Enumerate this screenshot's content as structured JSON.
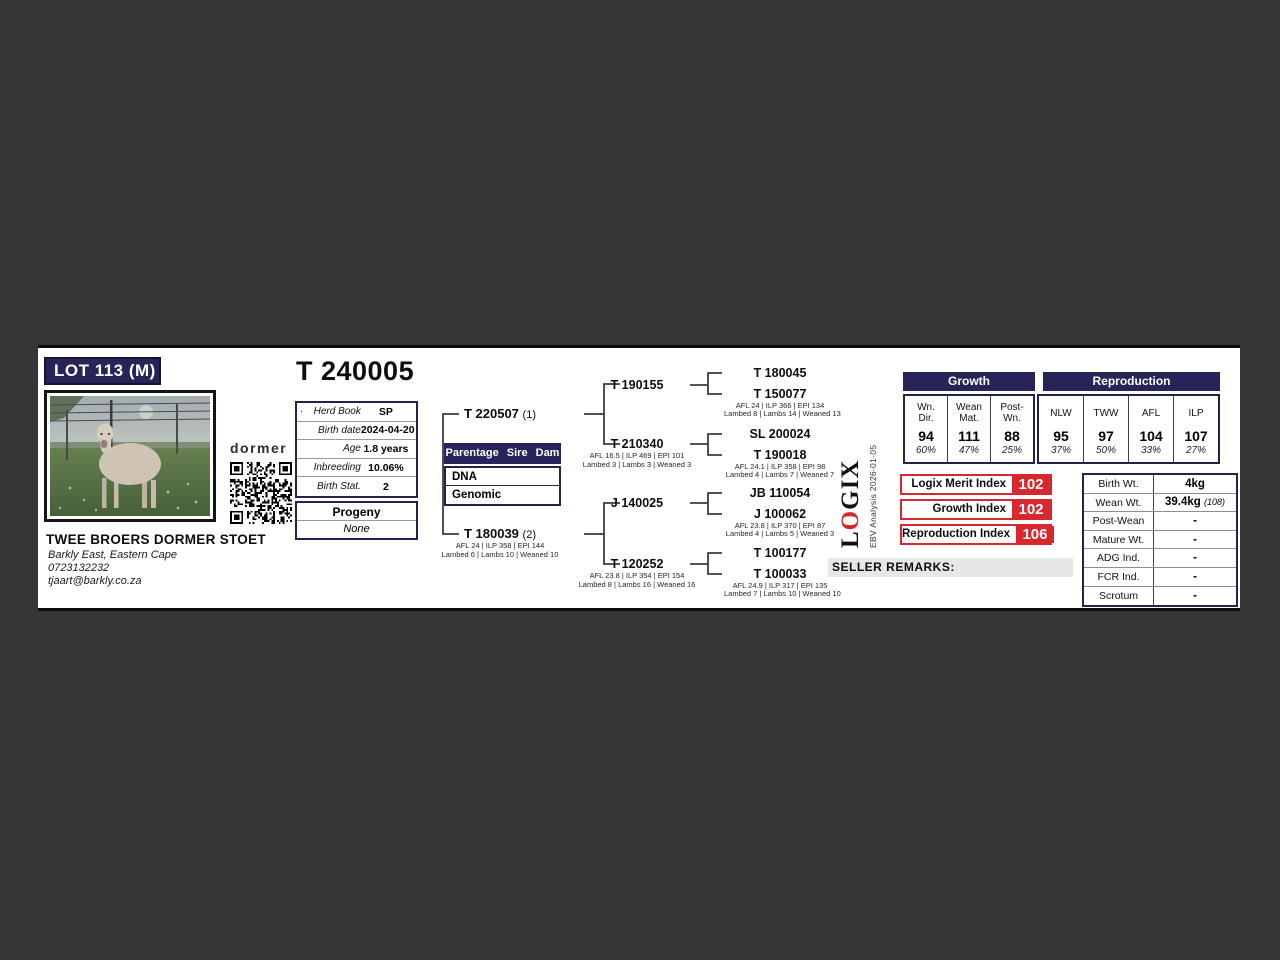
{
  "card": {
    "lot_badge": "LOT 113 (M)",
    "animal_id": "T 240005"
  },
  "breeder": {
    "brand": "dormer",
    "name": "TWEE BROERS DORMER STOET",
    "location": "Barkly East, Eastern Cape",
    "phone": "0723132232",
    "email": "tjaart@barkly.co.za"
  },
  "info": {
    "rows": [
      {
        "prefix": ".",
        "label": "Herd Book",
        "value": "SP"
      },
      {
        "label": "Birth date",
        "value": "2024-04-20"
      },
      {
        "label": "Age",
        "value": "1.8 years"
      },
      {
        "label": "Inbreeding",
        "value": "10.06%"
      },
      {
        "label": "Birth Stat.",
        "value": "2"
      }
    ]
  },
  "progeny": {
    "header": "Progeny",
    "value": "None"
  },
  "parentage": {
    "header": "Parentage Sire Dam",
    "rows": [
      "DNA",
      "Genomic"
    ]
  },
  "pedigree": {
    "sire": {
      "id": "T 220507",
      "tag": "(1)"
    },
    "dam": {
      "id": "T 180039",
      "tag": "(2)",
      "stats": "AFL 24 | ILP 358 | EPI 144",
      "lambing": "Lambed 6 | Lambs 10 | Weaned 10"
    },
    "gen2": [
      {
        "id": "T 190155"
      },
      {
        "id": "T 210340",
        "stats": "AFL 16.5 | ILP 469 | EPI 101",
        "lambing": "Lambed 3 | Lambs 3 | Weaned 3"
      },
      {
        "id": "J 140025"
      },
      {
        "id": "T 120252",
        "stats": "AFL 23.8 | ILP 354 | EPI 154",
        "lambing": "Lambed 8 | Lambs 16 | Weaned 16"
      }
    ],
    "gen3": [
      {
        "id": "T 180045"
      },
      {
        "id": "T 150077",
        "stats": "AFL 24 | ILP 366 | EPI 134",
        "lambing": "Lambed 8 | Lambs 14 | Weaned 13"
      },
      {
        "id": "SL 200024"
      },
      {
        "id": "T 190018",
        "stats": "AFL 24.1 | ILP 358 | EPI 98",
        "lambing": "Lambed 4 | Lambs 7 | Weaned 7"
      },
      {
        "id": "JB 110054"
      },
      {
        "id": "J 100062",
        "stats": "AFL 23.8 | ILP 370 | EPI 87",
        "lambing": "Lambed 4 | Lambs 5 | Weaned 3"
      },
      {
        "id": "T 100177"
      },
      {
        "id": "T 100033",
        "stats": "AFL 24.9 | ILP 317 | EPI 135",
        "lambing": "Lambed 7 | Lambs 10 | Weaned 10"
      }
    ]
  },
  "ebv": {
    "growth": {
      "header": "Growth",
      "cols": [
        {
          "l1": "Wn.",
          "l2": "Dir.",
          "value": "94",
          "acc": "60%"
        },
        {
          "l1": "Wean",
          "l2": "Mat.",
          "value": "111",
          "acc": "47%"
        },
        {
          "l1": "Post-",
          "l2": "Wn.",
          "value": "88",
          "acc": "25%"
        }
      ]
    },
    "reproduction": {
      "header": "Reproduction",
      "cols": [
        {
          "l1": "NLW",
          "value": "95",
          "acc": "37%"
        },
        {
          "l1": "TWW",
          "value": "97",
          "acc": "50%"
        },
        {
          "l1": "AFL",
          "value": "104",
          "acc": "33%"
        },
        {
          "l1": "ILP",
          "value": "107",
          "acc": "27%"
        }
      ]
    }
  },
  "logix": {
    "logo_l": "L",
    "logo_o": "O",
    "logo_gix": "GIX",
    "analysis": "EBV Analysis 2026-01-05",
    "indices": [
      {
        "label": "Logix Merit Index",
        "value": "102"
      },
      {
        "label": "Growth Index",
        "value": "102"
      },
      {
        "label": "Reproduction Index",
        "value": "106"
      }
    ]
  },
  "seller_remarks_label": "SELLER REMARKS:",
  "weights": {
    "rows": [
      {
        "label": "Birth Wt.",
        "value": "4kg",
        "note": ""
      },
      {
        "label": "Wean Wt.",
        "value": "39.4kg",
        "note": "(108)"
      },
      {
        "label": "Post-Wean",
        "value": "-",
        "note": ""
      },
      {
        "label": "Mature Wt.",
        "value": "-",
        "note": ""
      },
      {
        "label": "ADG Ind.",
        "value": "-",
        "note": ""
      },
      {
        "label": "FCR Ind.",
        "value": "-",
        "note": ""
      },
      {
        "label": "Scrotum",
        "value": "-",
        "note": ""
      }
    ]
  },
  "colors": {
    "navy": "#272459",
    "red": "#d7282f",
    "background": "#363636"
  }
}
